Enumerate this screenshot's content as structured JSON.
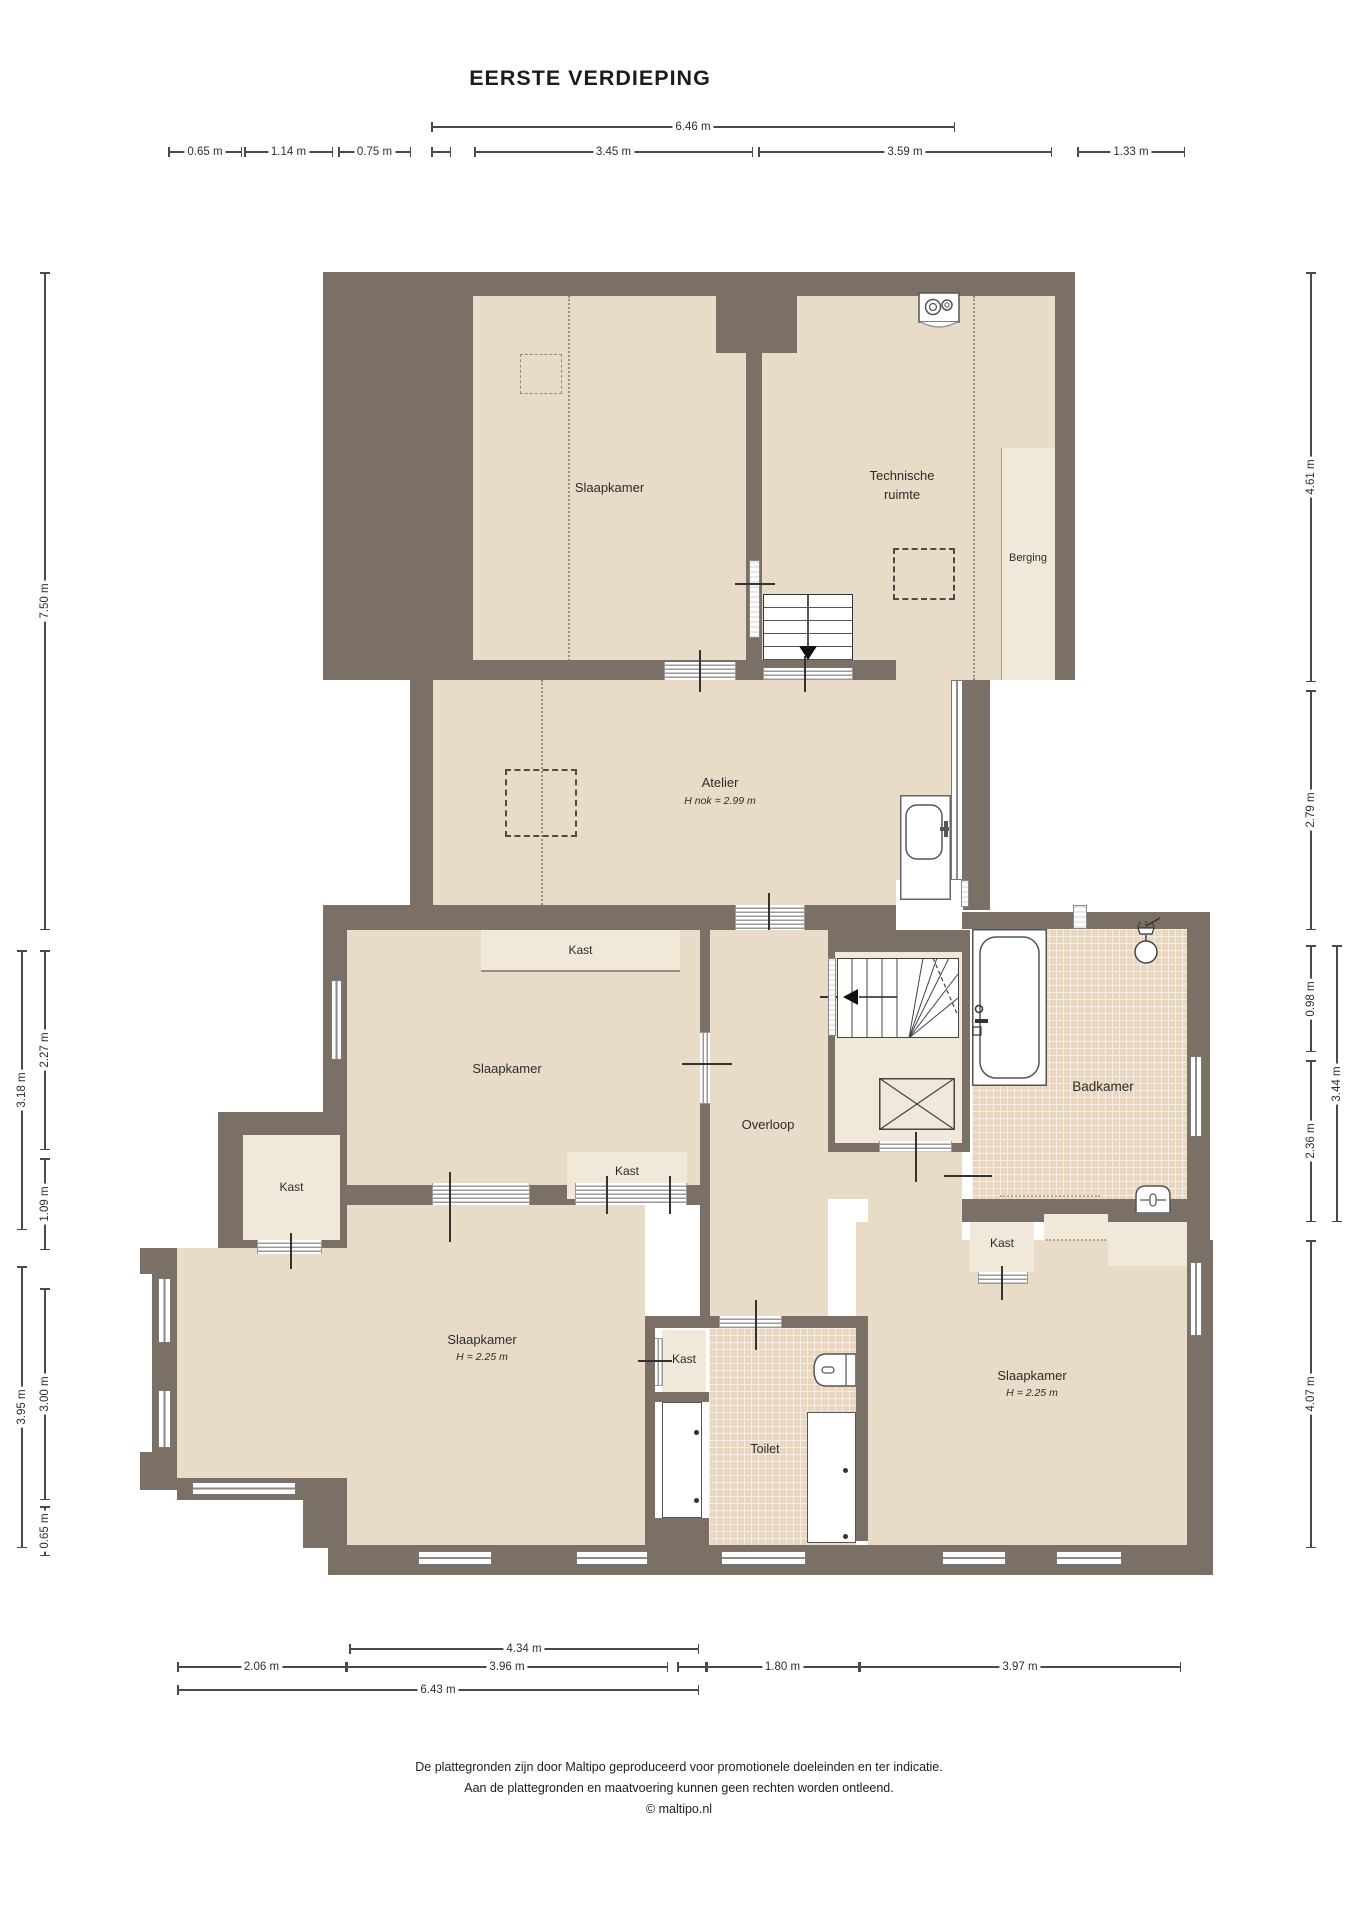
{
  "title": "EERSTE VERDIEPING",
  "colors": {
    "wall": "#7b7065",
    "floor": "#e8dcc8",
    "light": "#f0e9da",
    "tile": "#ead7c1"
  },
  "rooms": {
    "slaapkamer_boven": {
      "label": "Slaapkamer"
    },
    "technische_ruimte": {
      "label": "Technische ruimte"
    },
    "berging": {
      "label": "Berging"
    },
    "atelier": {
      "label": "Atelier",
      "height_note": "H nok = 2.99 m"
    },
    "slaapkamer_midden": {
      "label": "Slaapkamer"
    },
    "overloop": {
      "label": "Overloop"
    },
    "badkamer": {
      "label": "Badkamer"
    },
    "slaapkamer_linksonder": {
      "label": "Slaapkamer",
      "height_note": "H = 2.25 m"
    },
    "slaapkamer_rechtsonder": {
      "label": "Slaapkamer",
      "height_note": "H = 2.25 m"
    },
    "toilet": {
      "label": "Toilet"
    },
    "kast": {
      "label": "Kast"
    }
  },
  "dimensions": {
    "top": [
      {
        "label": "6.46 m",
        "x1": 431,
        "x2": 955,
        "y": 127
      },
      {
        "label": "0.65 m",
        "x1": 168,
        "x2": 242,
        "y": 152
      },
      {
        "label": "1.14 m",
        "x1": 244,
        "x2": 333,
        "y": 152
      },
      {
        "label": "0.75 m",
        "x1": 338,
        "x2": 411,
        "y": 152
      },
      {
        "label": "",
        "x1": 431,
        "x2": 451,
        "y": 152
      },
      {
        "label": "3.45 m",
        "x1": 474,
        "x2": 753,
        "y": 152
      },
      {
        "label": "3.59 m",
        "x1": 758,
        "x2": 1052,
        "y": 152
      },
      {
        "label": "1.33 m",
        "x1": 1077,
        "x2": 1185,
        "y": 152
      }
    ],
    "left": [
      {
        "label": "7.50 m",
        "y1": 272,
        "y2": 930,
        "x": 45
      },
      {
        "label": "2.27 m",
        "y1": 950,
        "y2": 1150,
        "x": 45
      },
      {
        "label": "3.18 m",
        "y1": 950,
        "y2": 1230,
        "x": 22
      },
      {
        "label": "1.09 m",
        "y1": 1158,
        "y2": 1250,
        "x": 45
      },
      {
        "label": "3.00 m",
        "y1": 1288,
        "y2": 1500,
        "x": 45
      },
      {
        "label": "3.95 m",
        "y1": 1266,
        "y2": 1548,
        "x": 22
      },
      {
        "label": "0.65 m",
        "y1": 1506,
        "y2": 1556,
        "x": 45
      }
    ],
    "right": [
      {
        "label": "4.61 m",
        "y1": 272,
        "y2": 682,
        "x": 1311
      },
      {
        "label": "2.79 m",
        "y1": 690,
        "y2": 930,
        "x": 1311
      },
      {
        "label": "0.98 m",
        "y1": 945,
        "y2": 1052,
        "x": 1311
      },
      {
        "label": "3.44 m",
        "y1": 945,
        "y2": 1222,
        "x": 1337
      },
      {
        "label": "2.36 m",
        "y1": 1060,
        "y2": 1222,
        "x": 1311
      },
      {
        "label": "4.07 m",
        "y1": 1240,
        "y2": 1548,
        "x": 1311
      }
    ],
    "bottom": [
      {
        "label": "4.34 m",
        "x1": 349,
        "x2": 699,
        "y": 1649
      },
      {
        "label": "2.06 m",
        "x1": 177,
        "x2": 346,
        "y": 1667
      },
      {
        "label": "3.96 m",
        "x1": 346,
        "x2": 668,
        "y": 1667
      },
      {
        "label": "",
        "x1": 677,
        "x2": 706,
        "y": 1667
      },
      {
        "label": "1.80 m",
        "x1": 706,
        "x2": 859,
        "y": 1667
      },
      {
        "label": "3.97 m",
        "x1": 859,
        "x2": 1181,
        "y": 1667
      },
      {
        "label": "6.43 m",
        "x1": 177,
        "x2": 699,
        "y": 1690
      }
    ]
  },
  "footer": {
    "line1": "De plattegronden zijn door Maltipo geproduceerd voor promotionele doeleinden en ter indicatie.",
    "line2": "Aan de plattegronden en maatvoering kunnen geen rechten worden ontleend.",
    "line3": "© maltipo.nl"
  }
}
